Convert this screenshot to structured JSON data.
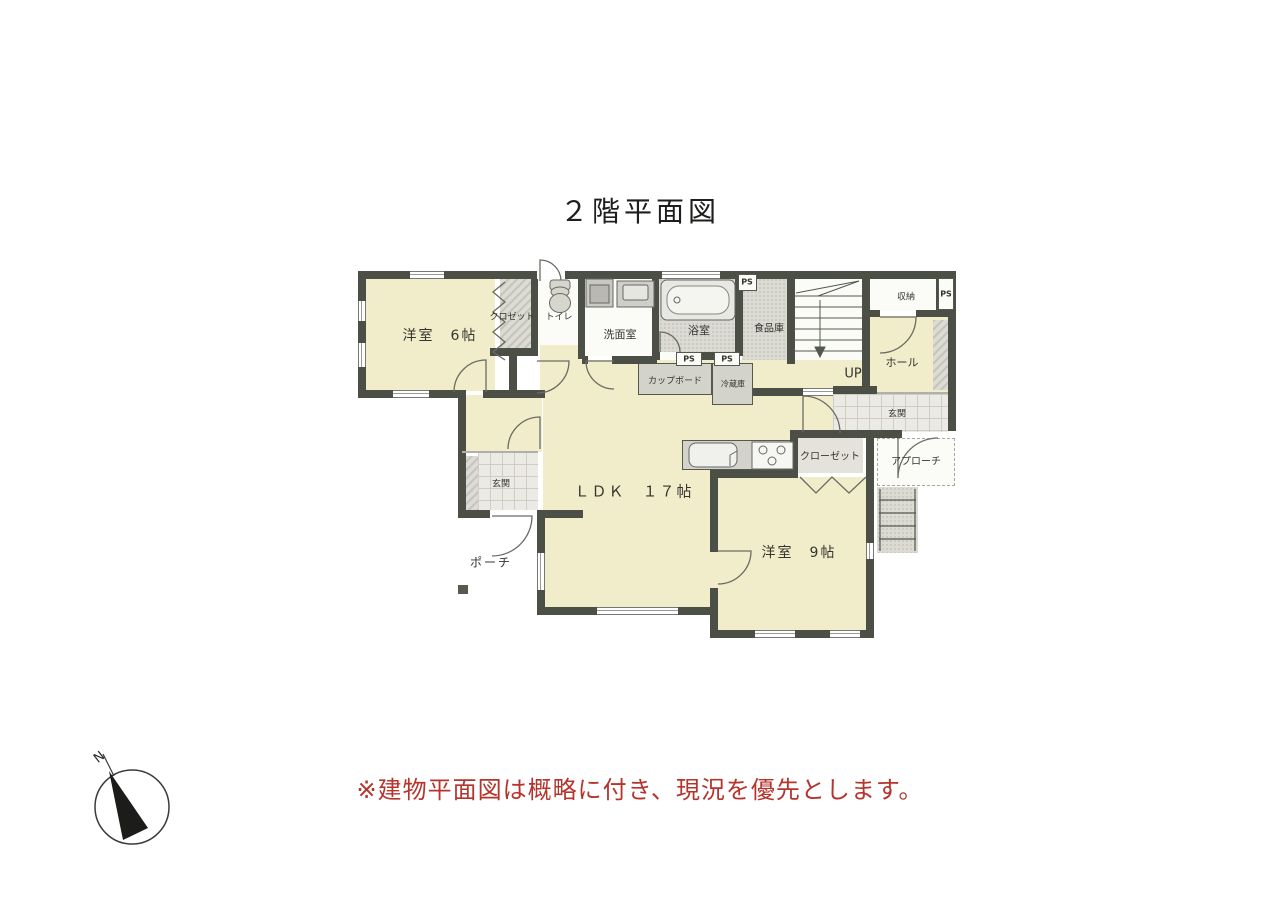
{
  "title": "２階平面図",
  "note": "※建物平面図は概略に付き、現況を優先とします。",
  "compass": {
    "north": "N"
  },
  "colors": {
    "wall": "#4b4f45",
    "room_cream": "#f1ecca",
    "accent_red": "#b5342c"
  },
  "rooms": {
    "bedroom6": "洋室　6帖",
    "closet_small": "クロゼット",
    "toilet": "トイレ",
    "washroom": "洗面室",
    "bathroom": "浴室",
    "pantry": "食品庫",
    "storage": "収納",
    "hall": "ホール",
    "stairs_up": "UP",
    "entrance": "玄関",
    "approach": "アプローチ",
    "closet": "クローゼット",
    "cupboard": "カップボード",
    "fridge": "冷蔵庫",
    "ldk": "ＬＤＫ　１７帖",
    "bedroom9": "洋室　9帖",
    "porch": "ポーチ",
    "ps": "PS"
  }
}
